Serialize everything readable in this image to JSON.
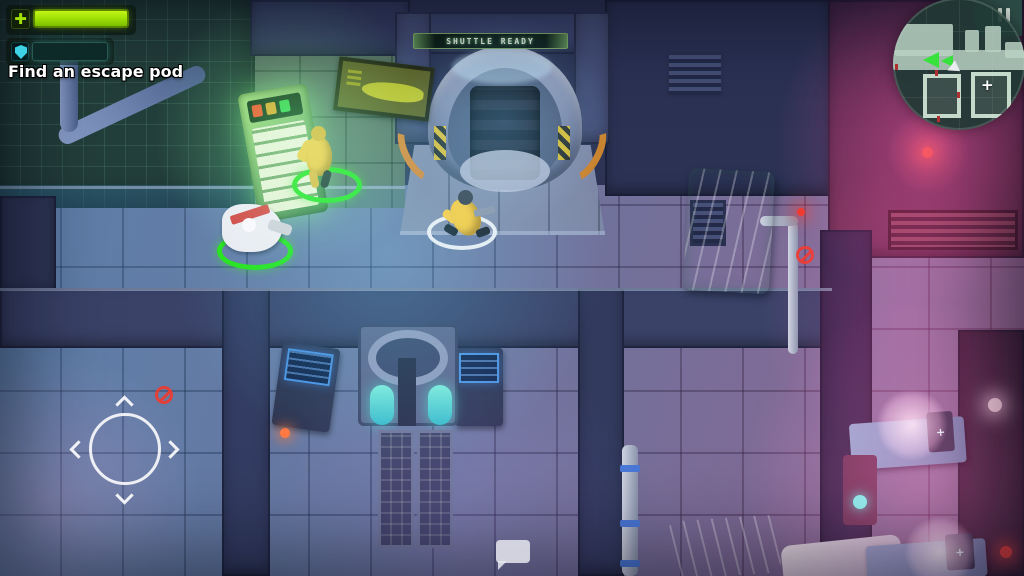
{
  "hud": {
    "objective": "Find an escape pod",
    "health": {
      "icon": "plus-icon",
      "plus_glyph": "✚",
      "percent": 100
    },
    "shield": {
      "icon": "shield-icon",
      "segments": 7
    },
    "shuttle_sign": "SHUTTLE READY",
    "minimap": {
      "objective_marker": "+",
      "pause_icon": "pause-icon"
    },
    "chat": {
      "icon": "chat-bubble-icon"
    }
  },
  "scene": {
    "medbay_bed_marker": "+"
  },
  "colors": {
    "health-green": "#a2e206",
    "health-border": "#456600",
    "shield-cyan": "#3ed2e6",
    "shield-seg": "#e6fdff",
    "ring-ally": "#27e213",
    "ring-player": "#e9f1f7",
    "sign-green": "#62935a",
    "map-bg": "#24443e",
    "map-shape": "#b9d1c2",
    "arrow-green": "#38e23c",
    "alert-red": "#ef3a2e",
    "objective-white": "#ffffff"
  }
}
